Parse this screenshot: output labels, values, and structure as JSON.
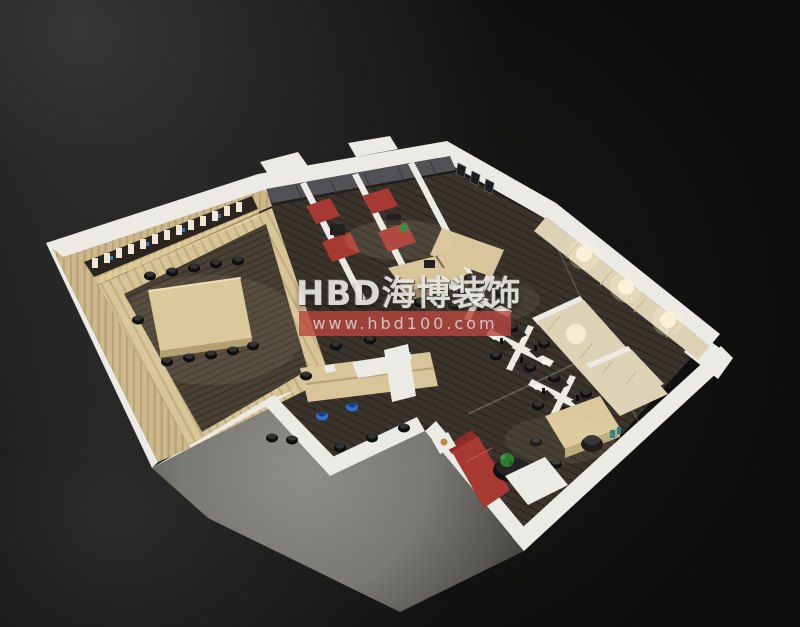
{
  "meta": {
    "description": "3D cutaway axonometric rendering of an office interior floor plan at night on a dark background",
    "rooms": [
      "conference-room",
      "meeting-rooms",
      "corridor",
      "open-workstation-area",
      "open-office",
      "executive-office",
      "storage-corridor"
    ]
  },
  "watermark": {
    "brand": "HBD海博装饰",
    "url": "www.hbd100.com"
  },
  "colors": {
    "bg": "#0b0b0b",
    "wall": "#eceae5",
    "wallShade": "#c9c7c0",
    "woodLight": "#d8c59a",
    "woodDark": "#b49a6d",
    "cabinetGray": "#515156",
    "beige": "#ded2b6",
    "sofaRed": "#a83832",
    "chairBlack": "#161616",
    "chairBlue": "#2f6fd8",
    "plantGreen": "#2f7d32",
    "watermarkRed": "#b8463e",
    "watermarkText": "#e8e6e2"
  }
}
